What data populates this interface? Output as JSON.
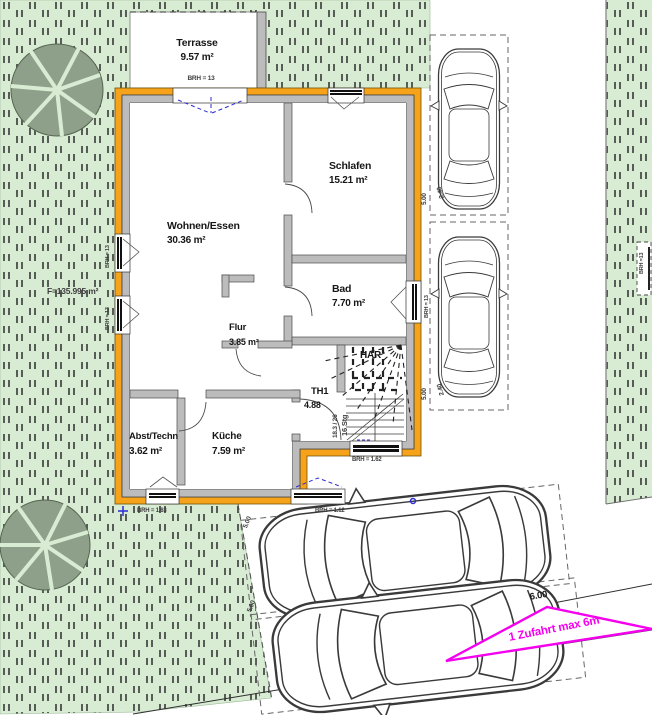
{
  "terrace": {
    "name": "Terrasse",
    "area": "9.57 m²",
    "sill": "BRH = 13"
  },
  "rooms": {
    "wohnen": {
      "name": "Wohnen/Essen",
      "area": "30.36 m²"
    },
    "schlafen": {
      "name": "Schlafen",
      "area": "15.21 m²"
    },
    "bad": {
      "name": "Bad",
      "area": "7.70 m²"
    },
    "flur": {
      "name": "Flur",
      "area": "3.85 m²"
    },
    "th1": {
      "name": "TH1",
      "area": "4.88"
    },
    "har": {
      "name": "HAR"
    },
    "abst": {
      "name": "Abst/Techn",
      "area": "3.62 m²"
    },
    "kueche": {
      "name": "Küche",
      "area": "7.59 m²"
    }
  },
  "stairs": {
    "count": "16 Stg",
    "step": "18.3 / 26"
  },
  "sills": {
    "left_upper": "BRH = 13",
    "left_lower": "BRH = 13",
    "bad": "BRH = 13",
    "neighbor": "BRH =13",
    "abst": "BRH = 1.63",
    "kueche": "BRH = 1.12",
    "stair": "BRH = 1.62"
  },
  "site": {
    "parcel_area": "F=135.995 m²",
    "access": "1 Zufahrt max 6m",
    "access_width": "6.00"
  },
  "parking": {
    "width": "2.40",
    "length": "5.00"
  },
  "colors": {
    "wall_orange": "#F6A21B",
    "wall_gray": "#BCBCBC",
    "site_green": "#D8EBD3",
    "hatch_dark": "#383838",
    "magenta": "#F400EE",
    "marker_blue": "#2B2BD5"
  }
}
